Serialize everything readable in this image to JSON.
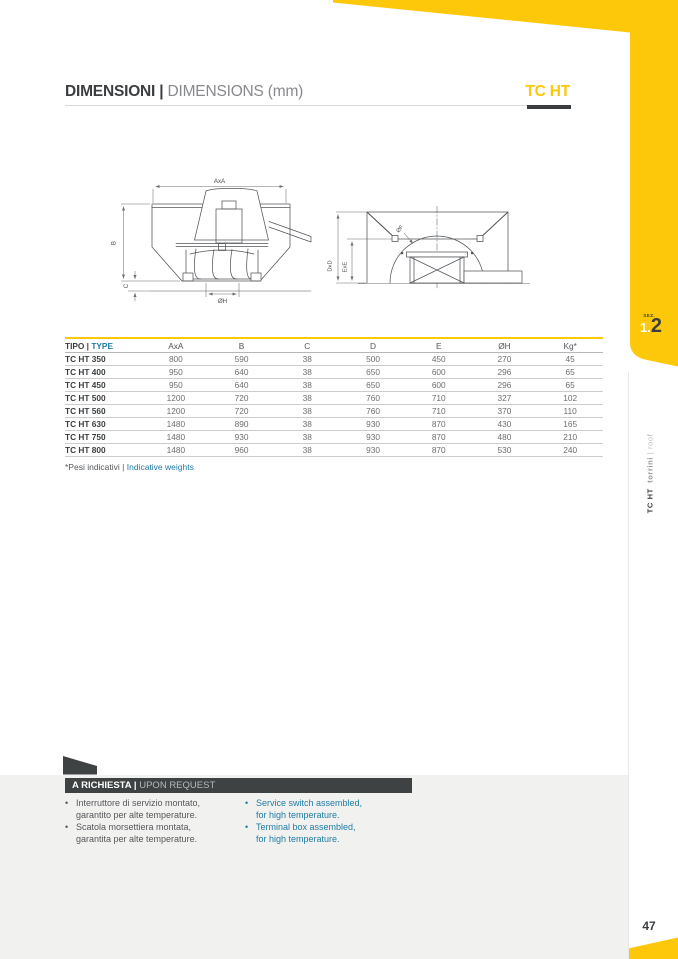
{
  "header": {
    "title_bold": "DIMENSIONI |",
    "title_light": "DIMENSIONS (mm)",
    "product": "TC HT"
  },
  "drawing": {
    "labels": {
      "axa": "AxA",
      "b": "B",
      "c": "C",
      "oh": "ØH",
      "dxd": "DxD",
      "exe": "ExE",
      "of": "ØF"
    }
  },
  "table": {
    "type_it": "TIPO |",
    "type_en": "TYPE",
    "columns": [
      "AxA",
      "B",
      "C",
      "D",
      "E",
      "ØH",
      "Kg*"
    ],
    "rows": [
      {
        "type": "TC HT 350",
        "values": [
          "800",
          "590",
          "38",
          "500",
          "450",
          "270",
          "45"
        ]
      },
      {
        "type": "TC HT 400",
        "values": [
          "950",
          "640",
          "38",
          "650",
          "600",
          "296",
          "65"
        ]
      },
      {
        "type": "TC HT 450",
        "values": [
          "950",
          "640",
          "38",
          "650",
          "600",
          "296",
          "65"
        ]
      },
      {
        "type": "TC HT 500",
        "values": [
          "1200",
          "720",
          "38",
          "760",
          "710",
          "327",
          "102"
        ]
      },
      {
        "type": "TC HT 560",
        "values": [
          "1200",
          "720",
          "38",
          "760",
          "710",
          "370",
          "110"
        ]
      },
      {
        "type": "TC HT 630",
        "values": [
          "1480",
          "890",
          "38",
          "930",
          "870",
          "430",
          "165"
        ]
      },
      {
        "type": "TC HT 750",
        "values": [
          "1480",
          "930",
          "38",
          "930",
          "870",
          "480",
          "210"
        ]
      },
      {
        "type": "TC HT 800",
        "values": [
          "1480",
          "960",
          "38",
          "930",
          "870",
          "530",
          "240"
        ]
      }
    ],
    "foot_it": "*Pesi indicativi |",
    "foot_en": "Indicative weights"
  },
  "request": {
    "header_bold": "A RICHIESTA |",
    "header_light": "UPON REQUEST",
    "bullet": "•",
    "items_it": [
      [
        "Interruttore di servizio montato,",
        "garantito per alte temperature."
      ],
      [
        "Scatola morsettiera montata,",
        "garantita per alte temperature."
      ]
    ],
    "items_en": [
      [
        "Service switch assembled,",
        "for high temperature."
      ],
      [
        "Terminal box assembled,",
        "for high temperature."
      ]
    ]
  },
  "sidebar": {
    "sez": "SEZ.",
    "num_major": "1.",
    "num_minor": "2",
    "v_bold": "TC HT",
    "v_mid": "torrini",
    "v_sep": "|",
    "v_light": "roof"
  },
  "page": {
    "number": "47"
  },
  "colors": {
    "accent_yellow": "#FEC80A",
    "dark": "#3B3E40",
    "text_gray": "#6D6E70",
    "blue": "#1F7CA6",
    "bg_gray": "#F1F1EF"
  }
}
